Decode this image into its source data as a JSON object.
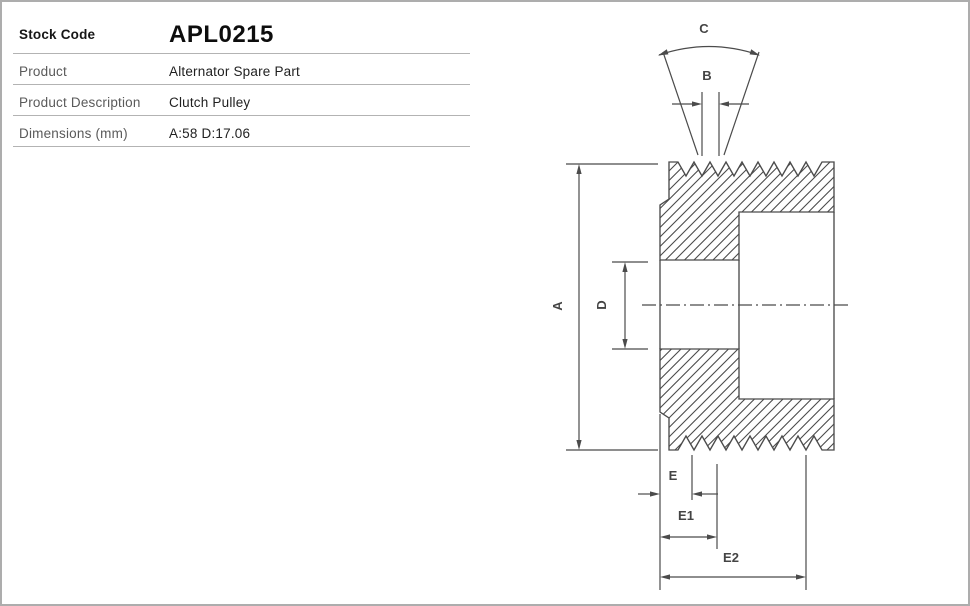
{
  "table": {
    "stock_code": {
      "label": "Stock Code",
      "value": "APL0215"
    },
    "rows": [
      {
        "label": "Product",
        "value": "Alternator Spare Part"
      },
      {
        "label": "Product Description",
        "value": "Clutch Pulley"
      },
      {
        "label": "Dimensions (mm)",
        "value": "A:58 D:17.06"
      }
    ]
  },
  "diagram": {
    "type": "engineering-cross-section",
    "subject": "clutch pulley",
    "dimension_labels": {
      "A": "A",
      "B": "B",
      "C": "C",
      "D": "D",
      "E": "E",
      "E1": "E1",
      "E2": "E2"
    }
  },
  "colors": {
    "drawing_line": "#4b4b4b",
    "divider": "#b3b3b3",
    "page_border": "#adadad",
    "label_text": "#5a5a5a",
    "value_text": "#1f1f1f"
  }
}
